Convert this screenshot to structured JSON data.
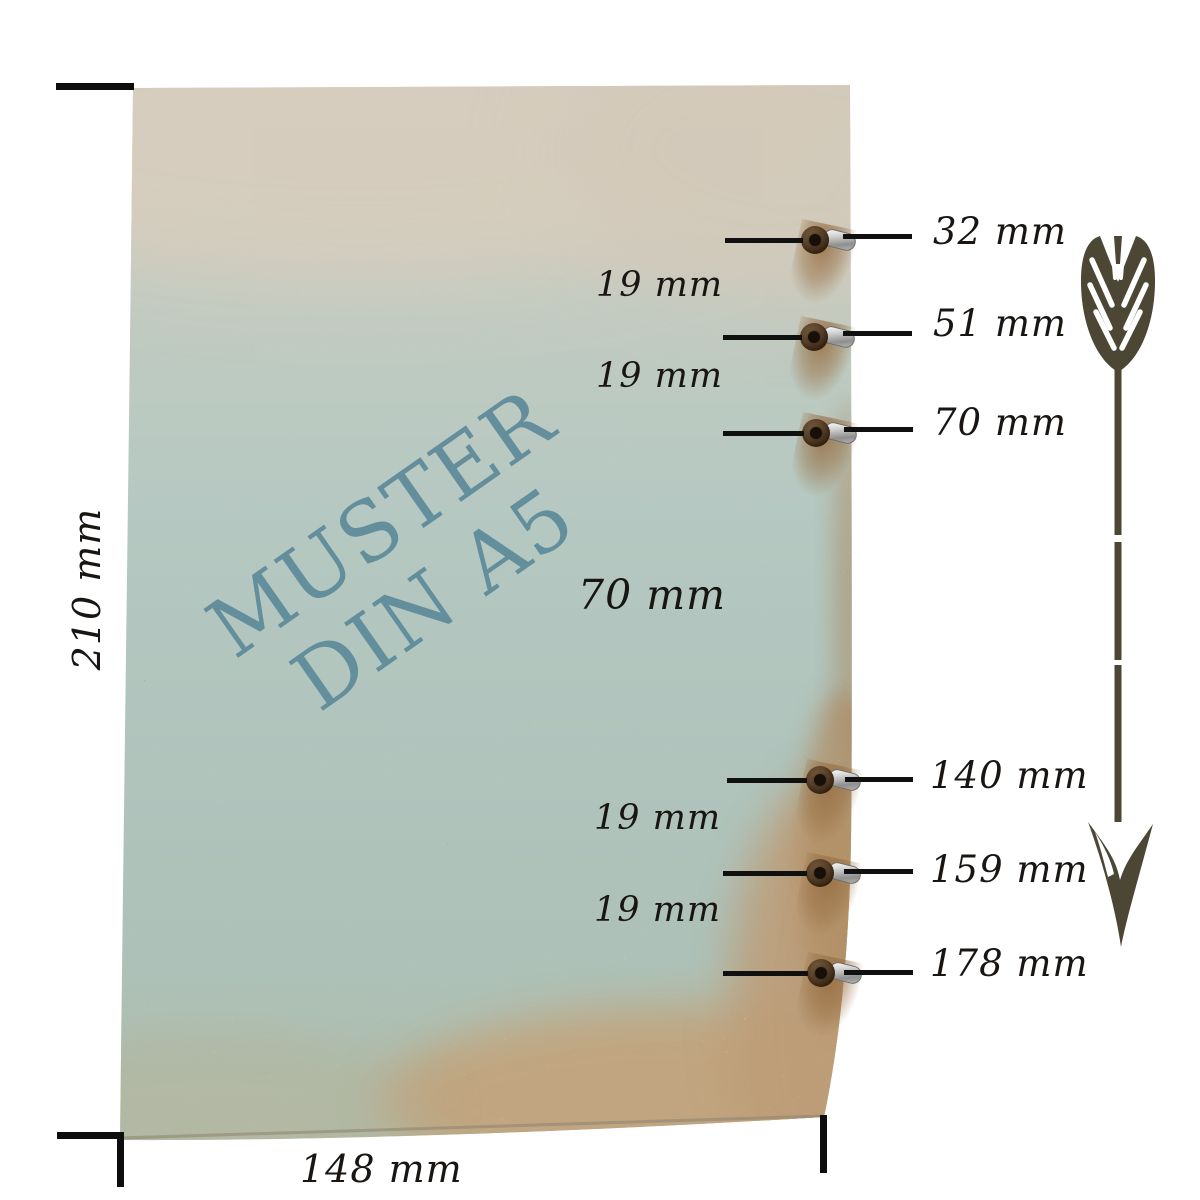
{
  "watermark": {
    "line1": "MUSTER",
    "line2": "DIN A5"
  },
  "outer_dimensions": {
    "height": "210 mm",
    "width": "148 mm"
  },
  "hole_spacing_labels": [
    {
      "text": "19 mm"
    },
    {
      "text": "19 mm"
    },
    {
      "text": "70 mm"
    },
    {
      "text": "19 mm"
    },
    {
      "text": "19 mm"
    }
  ],
  "hole_position_labels": [
    {
      "text": "32 mm"
    },
    {
      "text": "51 mm"
    },
    {
      "text": "70 mm"
    },
    {
      "text": "140 mm"
    },
    {
      "text": "159 mm"
    },
    {
      "text": "178 mm"
    }
  ],
  "eyelet_count": 6,
  "icons": {
    "arrow": "down-measurement-arrow-icon",
    "eyelet": "eyelet-grommet-icon"
  },
  "colors": {
    "paper_top_beige": "#d5ccbd",
    "paper_green": "#b3c8c1",
    "paper_tan": "#c1a47e",
    "watermark_teal": "#5d8a99",
    "label_ink": "#181512",
    "arrow_olive": "#4b4734",
    "eyelet_brown": "#5a422a",
    "eyelet_metal": "#c9c9c9"
  }
}
